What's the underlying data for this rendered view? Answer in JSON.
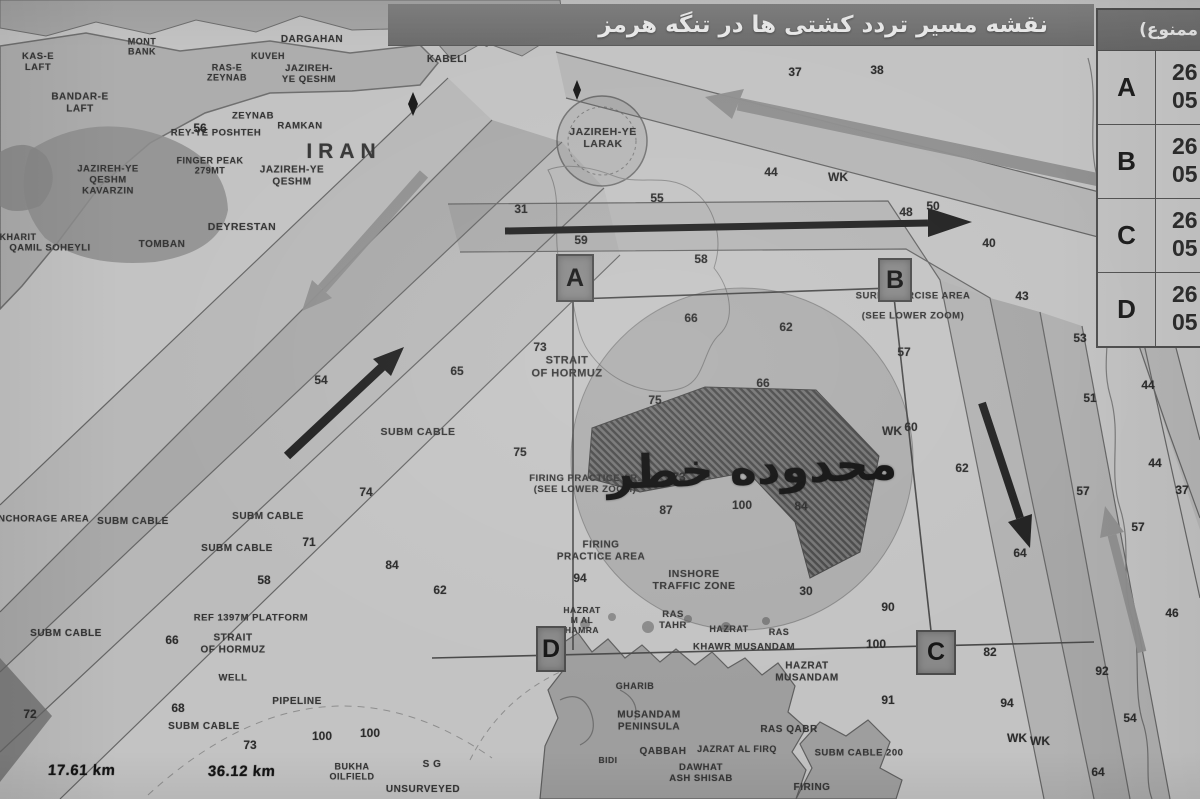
{
  "title": {
    "text": "نقشه مسیر تردد کشتی ها در تنگه هرمز"
  },
  "coords_table": {
    "header": "(محدوده تردد ممنوع)",
    "rows": [
      {
        "point": "A",
        "lat": "26",
        "lon": "05"
      },
      {
        "point": "B",
        "lat": "26",
        "lon": "05"
      },
      {
        "point": "C",
        "lat": "26",
        "lon": "05"
      },
      {
        "point": "D",
        "lat": "26",
        "lon": "05"
      }
    ]
  },
  "corner_markers": [
    {
      "letter": "A"
    },
    {
      "letter": "B"
    },
    {
      "letter": "C"
    },
    {
      "letter": "D"
    }
  ],
  "danger_zone": {
    "label": "محدوده خطر"
  },
  "scale_readouts": {
    "left": "17.61 km",
    "right": "36.12 km"
  },
  "colors": {
    "paper": "#c3c3c3",
    "land": "#a8a8a8",
    "titlebar": "#767676",
    "marker_bg": "#898989",
    "restricted_hatch": "#3f3f3f",
    "danger_fill": "rgba(40,40,40,0.15)",
    "arrow_black": "#222222",
    "arrow_gray": "#8f8f8f"
  },
  "map": {
    "arrows": [
      {
        "name": "eastbound-lane-arrow",
        "color": "black",
        "direction": "east"
      },
      {
        "name": "westbound-lane-arrow",
        "color": "gray",
        "direction": "west-northwest"
      },
      {
        "name": "northeast-inbound-arrow",
        "color": "black",
        "direction": "northeast"
      },
      {
        "name": "southwest-outbound-arrow",
        "color": "gray",
        "direction": "southwest"
      },
      {
        "name": "southbound-lane-arrow",
        "color": "black",
        "direction": "south"
      },
      {
        "name": "northbound-lane-arrow",
        "color": "gray",
        "direction": "north"
      }
    ],
    "labels": [
      {
        "x": 142,
        "y": 47,
        "t": "MONT\nBANK",
        "s": 9
      },
      {
        "x": 38,
        "y": 62,
        "t": "KAS-E\nLAFT",
        "s": 9.5
      },
      {
        "x": 312,
        "y": 40,
        "t": "DARGAHAN",
        "s": 10
      },
      {
        "x": 463,
        "y": 16,
        "t": "KABOLI",
        "s": 10
      },
      {
        "x": 500,
        "y": 42,
        "t": "QESHM",
        "s": 9.5
      },
      {
        "x": 447,
        "y": 60,
        "t": "KABELI",
        "s": 10
      },
      {
        "x": 268,
        "y": 56,
        "t": "KUVEH",
        "s": 9
      },
      {
        "x": 227,
        "y": 73,
        "t": "RAS-E\nZEYNAB",
        "s": 9
      },
      {
        "x": 309,
        "y": 74,
        "t": "JAZIREH-\nYE QESHM",
        "s": 9.5
      },
      {
        "x": 80,
        "y": 103,
        "t": "BANDAR-E\nLAFT",
        "s": 10
      },
      {
        "x": 253,
        "y": 116,
        "t": "ZEYNAB",
        "s": 9.5
      },
      {
        "x": 216,
        "y": 133,
        "t": "REY-YE POSHTEH",
        "s": 9.5
      },
      {
        "x": 300,
        "y": 126,
        "t": "RAMKAN",
        "s": 9.5
      },
      {
        "x": 344,
        "y": 152,
        "t": "IRAN",
        "s": 21,
        "ls": 6
      },
      {
        "x": 210,
        "y": 166,
        "t": "FINGER PEAK\n279MT",
        "s": 9
      },
      {
        "x": 292,
        "y": 176,
        "t": "JAZIREH-YE\nQESHM",
        "s": 10
      },
      {
        "x": 108,
        "y": 180,
        "t": "JAZIREH-YE\nQESHM\nKAVARZIN",
        "s": 9.5
      },
      {
        "x": 242,
        "y": 227,
        "t": "DEYRESTAN",
        "s": 10.5
      },
      {
        "x": 162,
        "y": 245,
        "t": "TOMBAN",
        "s": 10
      },
      {
        "x": 50,
        "y": 248,
        "t": "QAMIL SOHEYLI",
        "s": 9.5
      },
      {
        "x": 18,
        "y": 237,
        "t": "KHARIT",
        "s": 9
      },
      {
        "x": 603,
        "y": 138,
        "t": "JAZIREH-YE\nLARAK",
        "s": 10.5
      },
      {
        "x": 567,
        "y": 367,
        "t": "STRAIT\nOF HORMUZ",
        "s": 11
      },
      {
        "x": 418,
        "y": 432,
        "t": "SUBM CABLE",
        "s": 10.5
      },
      {
        "x": 585,
        "y": 484,
        "t": "FIRING PRACTICE AR.\n(SEE LOWER ZOOM)",
        "s": 9.5
      },
      {
        "x": 601,
        "y": 551,
        "t": "FIRING\nPRACTICE AREA",
        "s": 10
      },
      {
        "x": 694,
        "y": 580,
        "t": "INSHORE\nTRAFFIC ZONE",
        "s": 10.5
      },
      {
        "x": 913,
        "y": 296,
        "t": "SURF EXERCISE AREA",
        "s": 9.5
      },
      {
        "x": 913,
        "y": 316,
        "t": "(SEE LOWER ZOOM)",
        "s": 9.5
      },
      {
        "x": 268,
        "y": 517,
        "t": "SUBM CABLE",
        "s": 10
      },
      {
        "x": 133,
        "y": 522,
        "t": "SUBM CABLE",
        "s": 10
      },
      {
        "x": 237,
        "y": 549,
        "t": "SUBM CABLE",
        "s": 10
      },
      {
        "x": 66,
        "y": 634,
        "t": "SUBM CABLE",
        "s": 10
      },
      {
        "x": 204,
        "y": 727,
        "t": "SUBM CABLE",
        "s": 10
      },
      {
        "x": 40,
        "y": 519,
        "t": "ANCHORAGE AREA",
        "s": 9.5
      },
      {
        "x": 251,
        "y": 618,
        "t": "REF 1397M PLATFORM",
        "s": 9.5
      },
      {
        "x": 233,
        "y": 644,
        "t": "STRAIT\nOF HORMUZ",
        "s": 10
      },
      {
        "x": 233,
        "y": 678,
        "t": "WELL",
        "s": 9.5
      },
      {
        "x": 297,
        "y": 702,
        "t": "PIPELINE",
        "s": 10
      },
      {
        "x": 352,
        "y": 772,
        "t": "BUKHA\nOILFIELD",
        "s": 9
      },
      {
        "x": 432,
        "y": 765,
        "t": "S G",
        "s": 10
      },
      {
        "x": 423,
        "y": 790,
        "t": "UNSURVEYED",
        "s": 10
      },
      {
        "x": 582,
        "y": 621,
        "t": "HAZRAT\nM AL\nHAMRA",
        "s": 8.5
      },
      {
        "x": 673,
        "y": 620,
        "t": "RAS\nTAHR",
        "s": 9.5
      },
      {
        "x": 729,
        "y": 629,
        "t": "HAZRAT",
        "s": 9
      },
      {
        "x": 779,
        "y": 632,
        "t": "RAS",
        "s": 9
      },
      {
        "x": 744,
        "y": 647,
        "t": "KHAWR MUSANDAM",
        "s": 9.5
      },
      {
        "x": 807,
        "y": 672,
        "t": "HAZRAT\nMUSANDAM",
        "s": 10
      },
      {
        "x": 649,
        "y": 721,
        "t": "MUSANDAM\nPENINSULA",
        "s": 10
      },
      {
        "x": 663,
        "y": 752,
        "t": "QABBAH",
        "s": 10
      },
      {
        "x": 789,
        "y": 730,
        "t": "RAS QABR",
        "s": 10
      },
      {
        "x": 737,
        "y": 749,
        "t": "JAZRAT AL FIRQ",
        "s": 9
      },
      {
        "x": 859,
        "y": 753,
        "t": "SUBM CABLE 200",
        "s": 9.5
      },
      {
        "x": 701,
        "y": 773,
        "t": "DAWHAT\nASH SHISAB",
        "s": 9.5
      },
      {
        "x": 608,
        "y": 761,
        "t": "BIDI",
        "s": 8.5
      },
      {
        "x": 812,
        "y": 788,
        "t": "FIRING",
        "s": 10
      },
      {
        "x": 635,
        "y": 686,
        "t": "GHARIB",
        "s": 9
      }
    ],
    "soundings": [
      {
        "v": "37",
        "x": 795,
        "y": 72
      },
      {
        "v": "38",
        "x": 877,
        "y": 70
      },
      {
        "v": "44",
        "x": 771,
        "y": 172
      },
      {
        "v": "WK",
        "x": 838,
        "y": 177
      },
      {
        "v": "31",
        "x": 521,
        "y": 209
      },
      {
        "v": "55",
        "x": 657,
        "y": 198
      },
      {
        "v": "59",
        "x": 581,
        "y": 240
      },
      {
        "v": "58",
        "x": 701,
        "y": 259
      },
      {
        "v": "48",
        "x": 906,
        "y": 212
      },
      {
        "v": "50",
        "x": 933,
        "y": 206
      },
      {
        "v": "40",
        "x": 989,
        "y": 243
      },
      {
        "v": "43",
        "x": 1022,
        "y": 296
      },
      {
        "v": "66",
        "x": 691,
        "y": 318
      },
      {
        "v": "62",
        "x": 786,
        "y": 327
      },
      {
        "v": "57",
        "x": 904,
        "y": 352
      },
      {
        "v": "73",
        "x": 540,
        "y": 347
      },
      {
        "v": "65",
        "x": 457,
        "y": 371
      },
      {
        "v": "54",
        "x": 321,
        "y": 380
      },
      {
        "v": "75",
        "x": 655,
        "y": 400
      },
      {
        "v": "66",
        "x": 763,
        "y": 383
      },
      {
        "v": "60",
        "x": 911,
        "y": 427
      },
      {
        "v": "75",
        "x": 520,
        "y": 452
      },
      {
        "v": "73",
        "x": 679,
        "y": 477
      },
      {
        "v": "WK",
        "x": 892,
        "y": 431
      },
      {
        "v": "87",
        "x": 666,
        "y": 510
      },
      {
        "v": "84",
        "x": 801,
        "y": 506
      },
      {
        "v": "100",
        "x": 742,
        "y": 505
      },
      {
        "v": "94",
        "x": 580,
        "y": 578
      },
      {
        "v": "74",
        "x": 366,
        "y": 492
      },
      {
        "v": "71",
        "x": 309,
        "y": 542
      },
      {
        "v": "84",
        "x": 392,
        "y": 565
      },
      {
        "v": "58",
        "x": 264,
        "y": 580
      },
      {
        "v": "62",
        "x": 440,
        "y": 590
      },
      {
        "v": "66",
        "x": 172,
        "y": 640
      },
      {
        "v": "30",
        "x": 806,
        "y": 591
      },
      {
        "v": "90",
        "x": 888,
        "y": 607
      },
      {
        "v": "100",
        "x": 876,
        "y": 644
      },
      {
        "v": "91",
        "x": 888,
        "y": 700
      },
      {
        "v": "82",
        "x": 990,
        "y": 652
      },
      {
        "v": "94",
        "x": 1007,
        "y": 703
      },
      {
        "v": "WK",
        "x": 1017,
        "y": 738
      },
      {
        "v": "WK",
        "x": 1040,
        "y": 741
      },
      {
        "v": "62",
        "x": 962,
        "y": 468
      },
      {
        "v": "64",
        "x": 1020,
        "y": 553
      },
      {
        "v": "53",
        "x": 1080,
        "y": 338
      },
      {
        "v": "51",
        "x": 1090,
        "y": 398
      },
      {
        "v": "44",
        "x": 1148,
        "y": 385
      },
      {
        "v": "44",
        "x": 1155,
        "y": 463
      },
      {
        "v": "37",
        "x": 1182,
        "y": 490
      },
      {
        "v": "57",
        "x": 1083,
        "y": 491
      },
      {
        "v": "57",
        "x": 1138,
        "y": 527
      },
      {
        "v": "46",
        "x": 1172,
        "y": 613
      },
      {
        "v": "54",
        "x": 1130,
        "y": 718
      },
      {
        "v": "64",
        "x": 1098,
        "y": 772
      },
      {
        "v": "68",
        "x": 178,
        "y": 708
      },
      {
        "v": "72",
        "x": 30,
        "y": 714
      },
      {
        "v": "73",
        "x": 250,
        "y": 745
      },
      {
        "v": "100",
        "x": 322,
        "y": 736
      },
      {
        "v": "100",
        "x": 370,
        "y": 733
      },
      {
        "v": "56",
        "x": 200,
        "y": 128
      },
      {
        "v": "92",
        "x": 1102,
        "y": 671
      }
    ]
  }
}
